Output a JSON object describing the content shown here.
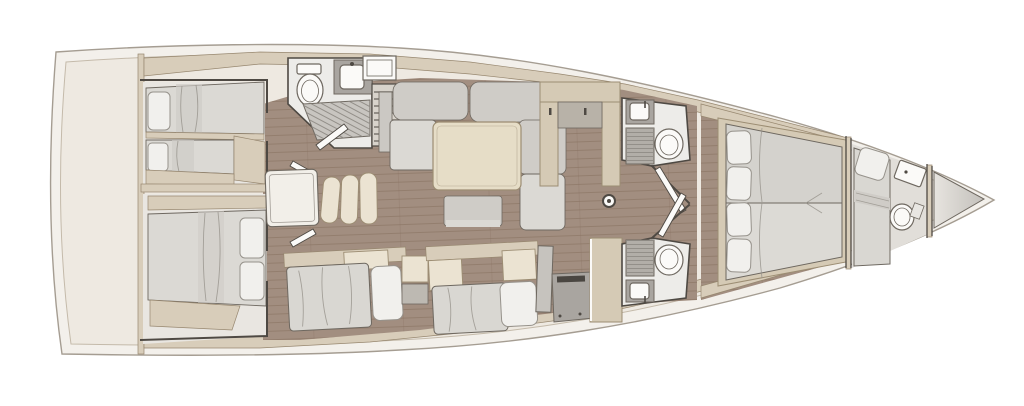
{
  "palette": {
    "page_bg": "#FFFFFF",
    "hull_fill": "#F3F0EB",
    "hull_stroke": "#A59D92",
    "deck_fill": "#EEE9E1",
    "deck_stroke": "#C4BAAA",
    "band": "#D8CDBA",
    "band_stroke": "#97876F",
    "wall": "#4E4943",
    "fixture": "#6E6860",
    "wood": "#A28E80",
    "wood_line": "#87705F",
    "cabin_floor": "#E9E6E1",
    "bath_floor": "#EDECE9",
    "counter": "#A9A5A0",
    "grate": "#C8C5C0",
    "grate_line": "#8D8983",
    "cushion": "#CFCCC7",
    "cushion_light": "#DBD9D4",
    "mattress": "#D9D7D2",
    "pillow": "#F1F0ED",
    "pillow_stroke": "#96928B",
    "cream": "#EBE3D2",
    "cream_dark": "#D5CAB5",
    "cream_stroke": "#9C8D73",
    "table_cream": "#E6DDC7",
    "fixture_white": "#FBFAF8",
    "stove": "#4A4641",
    "peak_light": "#E7E4DF",
    "peak_dark": "#C3C0BB"
  },
  "scene": {
    "type": "yacht-interior-floorplan",
    "orientation": {
      "bow": "right",
      "stern": "left"
    },
    "rooms": [
      {
        "name": "aft-cabin-port",
        "berths": "twin-singles"
      },
      {
        "name": "aft-cabin-starboard",
        "berths": "double"
      },
      {
        "name": "aft-head-with-shower",
        "fixtures": [
          "toilet",
          "sink",
          "shower-grate"
        ]
      },
      {
        "name": "companionway",
        "fixtures": [
          "steps",
          "hatch"
        ]
      },
      {
        "name": "saloon",
        "features": [
          "u-shaped-sofa",
          "dining-table",
          "ottoman",
          "chart-table",
          "stacked-chairs",
          "settee",
          "settee"
        ]
      },
      {
        "name": "galley",
        "fixtures": [
          "fridge-column",
          "counter-with-stove",
          "tall-locker"
        ]
      },
      {
        "name": "mast-post"
      },
      {
        "name": "forward-head-port",
        "fixtures": [
          "sink",
          "slatted-locker",
          "toilet"
        ]
      },
      {
        "name": "forward-head-starboard",
        "fixtures": [
          "sink",
          "slatted-locker",
          "toilet"
        ]
      },
      {
        "name": "owner-cabin",
        "berths": "island-double",
        "pillows": 4
      },
      {
        "name": "bow-crew-cabin",
        "berths": "single"
      },
      {
        "name": "bow-day-head",
        "fixtures": [
          "sink",
          "toilet"
        ]
      },
      {
        "name": "forepeak-locker"
      }
    ]
  }
}
